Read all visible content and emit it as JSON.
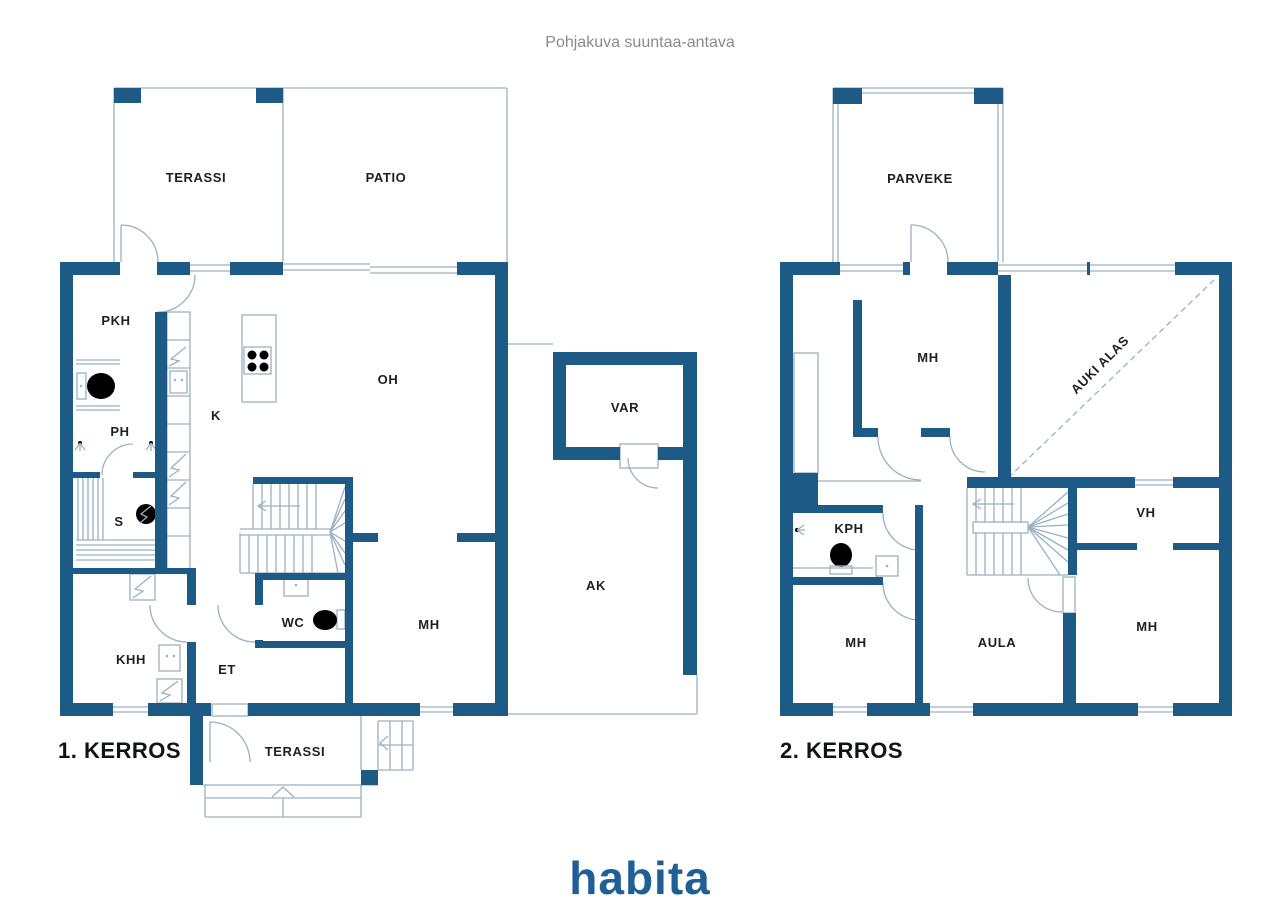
{
  "title": "Pohjakuva suuntaa-antava",
  "branding": {
    "logo": "habita"
  },
  "colors": {
    "wall": "#1E5A86",
    "thin_line": "#9BB0C3",
    "label_text": "#1C1F26",
    "title_text": "#8A8A8A",
    "logo_blue": "#1F5F95",
    "background": "#FFFFFF"
  },
  "icons": [
    "door-arc",
    "window",
    "stairs-icon",
    "toilet-icon",
    "sink-icon",
    "shower-icon",
    "stove-icon",
    "sauna-stove-icon",
    "appliance-icon",
    "direction-arrow"
  ],
  "floor1": {
    "name": "1. KERROS",
    "rooms": [
      {
        "label": "TERASSI",
        "x": 196,
        "y": 182
      },
      {
        "label": "PATIO",
        "x": 386,
        "y": 182
      },
      {
        "label": "PKH",
        "x": 116,
        "y": 325
      },
      {
        "label": "PH",
        "x": 120,
        "y": 436
      },
      {
        "label": "S",
        "x": 119,
        "y": 526
      },
      {
        "label": "K",
        "x": 216,
        "y": 420
      },
      {
        "label": "OH",
        "x": 388,
        "y": 384
      },
      {
        "label": "KHH",
        "x": 131,
        "y": 664
      },
      {
        "label": "ET",
        "x": 227,
        "y": 674
      },
      {
        "label": "WC",
        "x": 293,
        "y": 627
      },
      {
        "label": "MH",
        "x": 429,
        "y": 629
      },
      {
        "label": "VAR",
        "x": 625,
        "y": 412
      },
      {
        "label": "AK",
        "x": 596,
        "y": 590
      },
      {
        "label": "TERASSI",
        "x": 295,
        "y": 756
      }
    ]
  },
  "floor2": {
    "name": "2. KERROS",
    "rooms": [
      {
        "label": "PARVEKE",
        "x": 920,
        "y": 183
      },
      {
        "label": "MH",
        "x": 928,
        "y": 362
      },
      {
        "label": "AUKI ALAS",
        "x": 1103,
        "y": 368,
        "rotate": -45
      },
      {
        "label": "KPH",
        "x": 849,
        "y": 533
      },
      {
        "label": "VH",
        "x": 1146,
        "y": 517
      },
      {
        "label": "MH",
        "x": 856,
        "y": 647
      },
      {
        "label": "AULA",
        "x": 997,
        "y": 647
      },
      {
        "label": "MH",
        "x": 1147,
        "y": 631
      }
    ]
  }
}
